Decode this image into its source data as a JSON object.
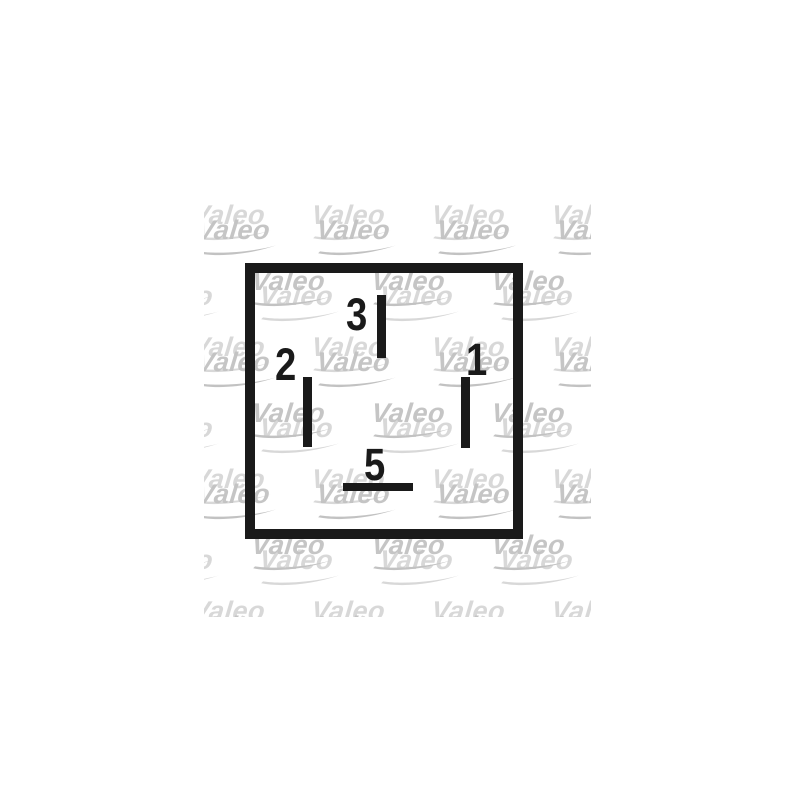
{
  "background_color": "#ffffff",
  "watermark": {
    "text": "Valeo",
    "solid_color": "#d8d8d8",
    "dotted_color": "#c2c2c2",
    "region": {
      "x": 204,
      "y": 199,
      "width": 387,
      "height": 418
    },
    "row_y": [
      202,
      268,
      334,
      400,
      466,
      532,
      598
    ],
    "col_x_even_rows": [
      193,
      313,
      433,
      553
    ],
    "col_x_odd_rows": [
      133,
      253,
      373,
      493
    ]
  },
  "diagram": {
    "line_color": "#1a1a1a",
    "label_color": "#1a1a1a",
    "outline": {
      "x": 245,
      "y": 263,
      "width": 278,
      "height": 276,
      "border": 10
    },
    "pins": [
      {
        "label": "3",
        "label_pos": {
          "x": 346,
          "y": 292
        },
        "line": {
          "x": 377,
          "y": 295,
          "width": 9,
          "height": 63
        }
      },
      {
        "label": "2",
        "label_pos": {
          "x": 275,
          "y": 342
        },
        "line": {
          "x": 303,
          "y": 377,
          "width": 9,
          "height": 70
        }
      },
      {
        "label": "1",
        "label_pos": {
          "x": 466,
          "y": 337
        },
        "line": {
          "x": 461,
          "y": 377,
          "width": 9,
          "height": 71
        }
      },
      {
        "label": "5",
        "label_pos": {
          "x": 364,
          "y": 442
        },
        "line": {
          "x": 343,
          "y": 483,
          "width": 70,
          "height": 8
        }
      }
    ]
  }
}
